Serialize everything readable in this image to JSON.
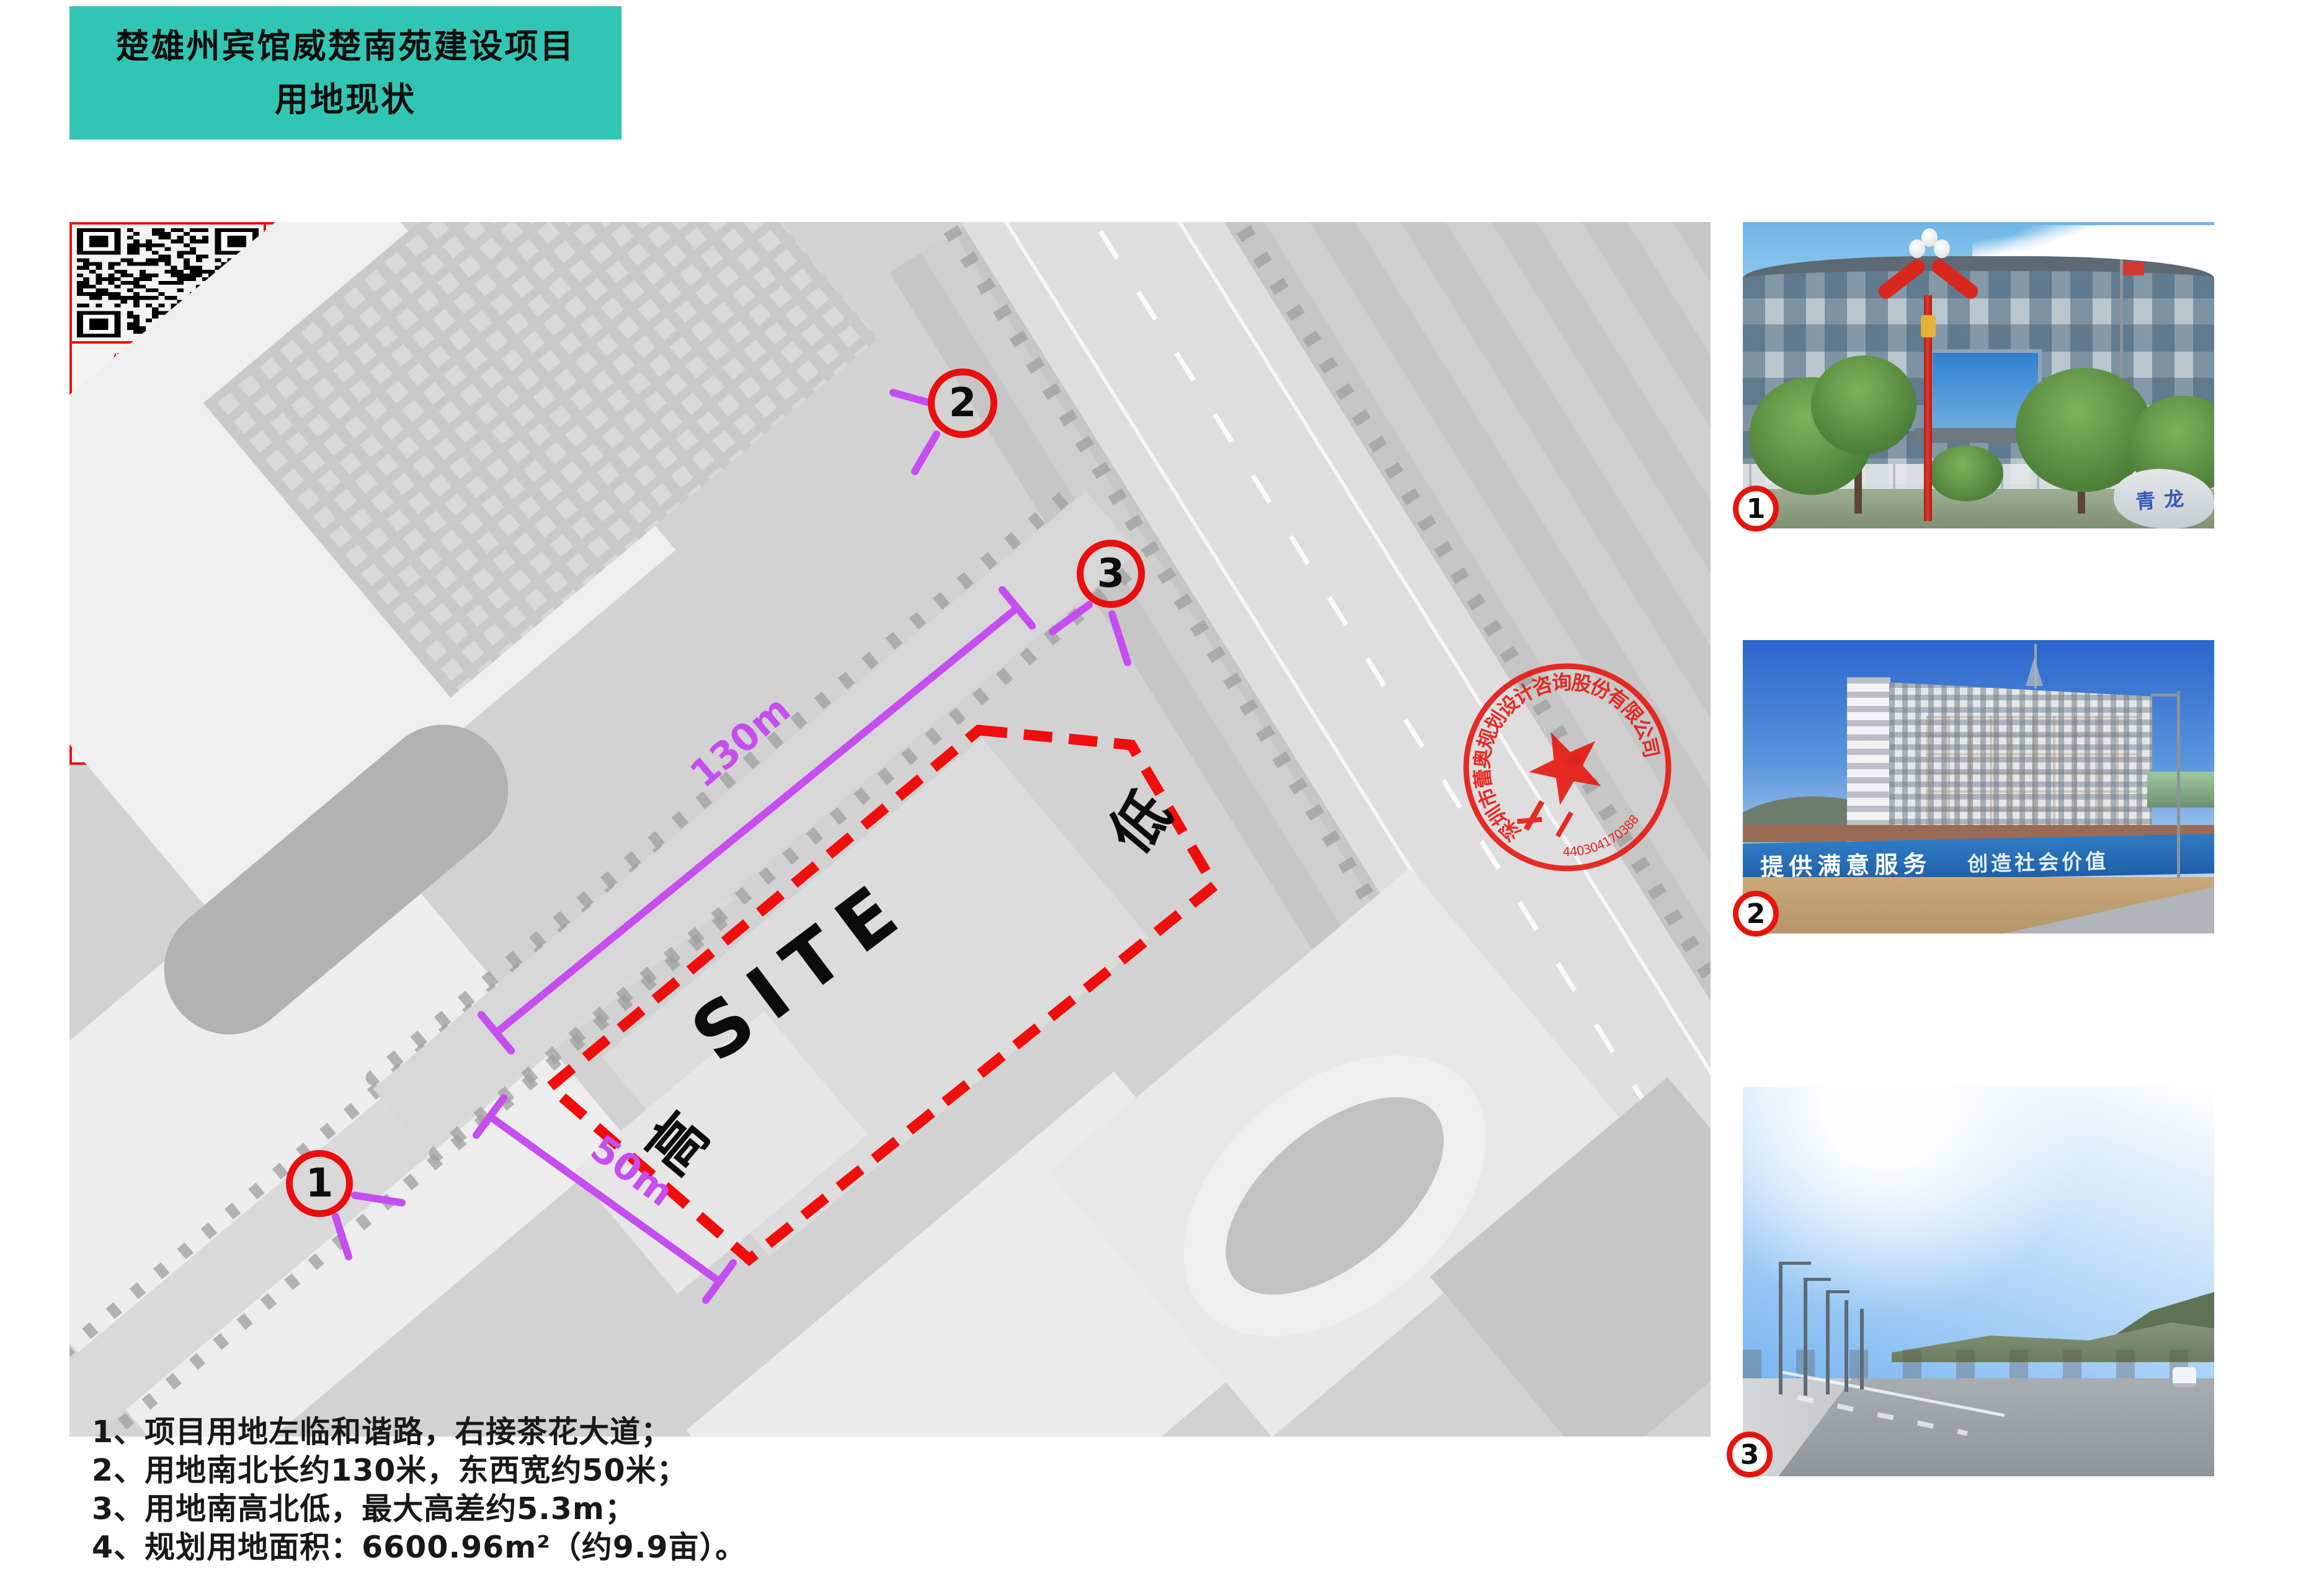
{
  "title_block": {
    "line1": "楚雄州宾馆威楚南苑建设项目",
    "line2": "用地现状",
    "bg_color": "#31c6b4"
  },
  "map": {
    "site_label": "SITE",
    "elevation_high": "高",
    "elevation_low": "低",
    "dim_length": "130m",
    "dim_width": "50m",
    "markers": [
      {
        "label": "1"
      },
      {
        "label": "2"
      },
      {
        "label": "3"
      }
    ],
    "colors": {
      "boundary": "#f20d0d",
      "dimension": "#c64df0",
      "marker_ring": "#ea0e0e"
    }
  },
  "stamp": {
    "company": "深圳市蕾奥规划设计咨询股份有限公司",
    "serial": "4403041703880",
    "color": "#e8130c"
  },
  "qr_panel": {
    "border_color": "#e8130c",
    "title": "云南省国土空间规划成果二维码",
    "fields": [
      {
        "name": "project-name",
        "lines": [
          "项目名称：楚雄州宾馆威楚南苑建设",
          "项目修建性详细规划"
        ]
      },
      {
        "name": "prepared-by",
        "lines": [
          "编制单位：深圳市蕾奥规划设计咨询",
          "股份有限公司"
        ]
      },
      {
        "name": "electronic-no",
        "lines": [
          "电子编号：G44319038240125001[4]"
        ]
      },
      {
        "name": "made-date",
        "lines": [
          "制作日期：2024年01月25日"
        ]
      }
    ]
  },
  "photos": [
    {
      "number": "1",
      "stone_text": "青龙"
    },
    {
      "number": "2",
      "banner_text": "提供满意服务",
      "banner_text2": "创造社会价值"
    },
    {
      "number": "3"
    }
  ],
  "notes": [
    "1、项目用地左临和谐路，右接茶花大道；",
    "2、用地南北长约130米，东西宽约50米；",
    "3、用地南高北低，最大高差约5.3m；",
    "4、规划用地面积：6600.96m²（约9.9亩）。"
  ]
}
